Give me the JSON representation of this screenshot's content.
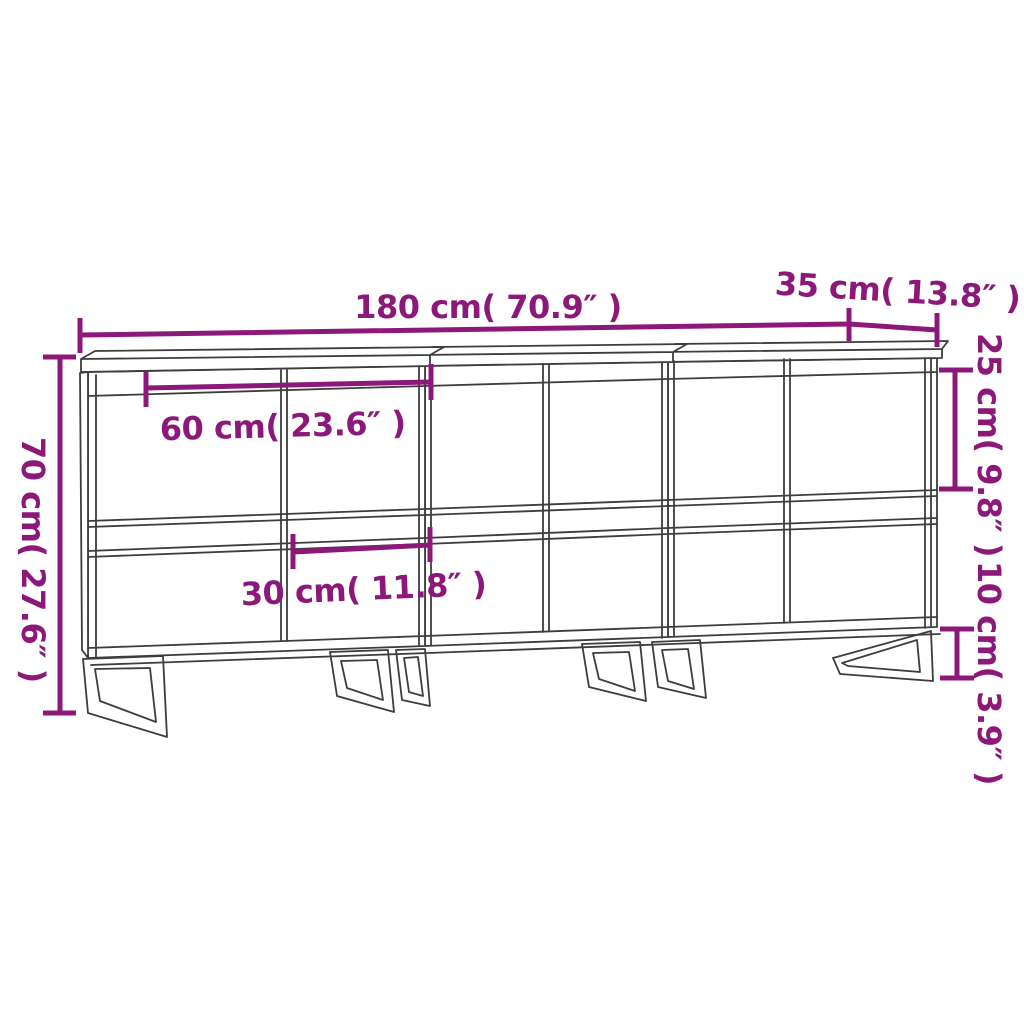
{
  "diagram": {
    "type": "furniture-dimension-diagram",
    "background_color": "#ffffff",
    "accent_color": "#8c1879",
    "line_color": "#3d3d3d",
    "labels": {
      "width": "180 cm( 70.9″  )",
      "depth": "35 cm( 13.8″  )",
      "height": "70 cm( 27.6″  )",
      "upper_height": "25 cm( 9.8″  )",
      "leg_height": "10 cm( 3.9″  )",
      "unit_width": "60 cm( 23.6″  )",
      "half_width": "30 cm( 11.8″  )"
    }
  }
}
